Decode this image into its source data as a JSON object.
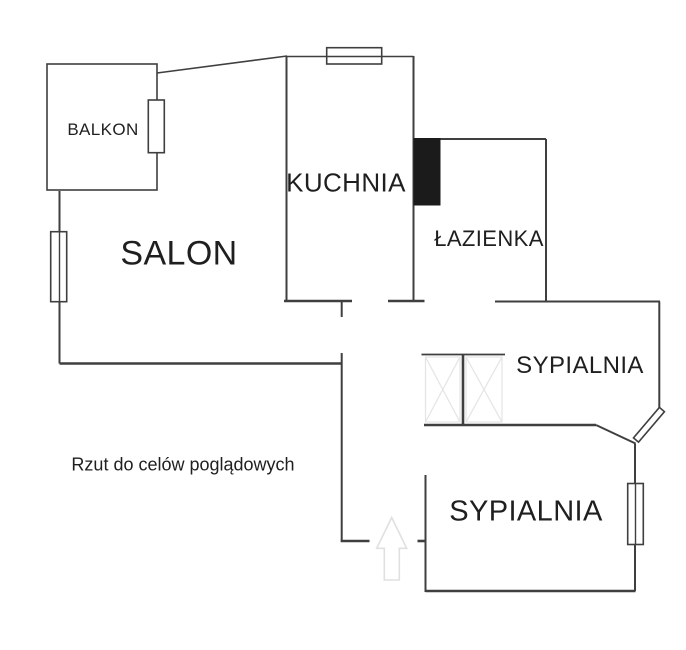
{
  "note": "Rzut do celów poglądowych",
  "rooms": {
    "balkon": {
      "label": "BALKON"
    },
    "salon": {
      "label": "SALON"
    },
    "kuchnia": {
      "label": "KUCHNIA"
    },
    "lazienka": {
      "label": "ŁAZIENKA"
    },
    "sypialnia_gorna": {
      "label": "SYPIALNIA"
    },
    "sypialnia_dolna": {
      "label": "SYPIALNIA"
    }
  },
  "colors": {
    "wall": "#3f3f3f",
    "chimney": "#1b1b1b",
    "furniture": "#e4e4e4",
    "arrow": "#e0e0e0",
    "background": "#ffffff",
    "text": "#1f1f1f"
  }
}
